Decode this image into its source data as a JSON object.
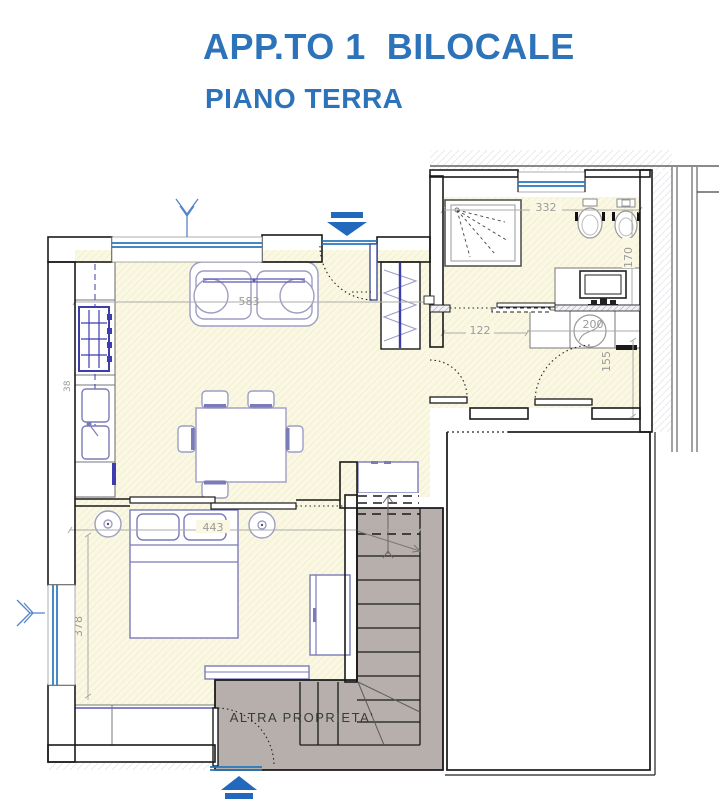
{
  "header": {
    "title": "APP.TO 1  BILOCALE",
    "subtitle": "PIANO TERRA"
  },
  "plan": {
    "dimensions": {
      "living_width": "583",
      "bath_width": "332",
      "bath_depth": "170",
      "hall_left": "122",
      "hall_right": "200",
      "hall_depth": "155",
      "bed_width": "443",
      "bed_depth": "378",
      "sink_width": "38"
    },
    "labels": {
      "other_property": "ALTRA PROPRIETA'"
    },
    "colors": {
      "accent_blue": "#2d73b9",
      "floor_yellow": "#faf8e2",
      "stair_gray": "#b6afab",
      "window_blue": "#2777bd",
      "furniture_blue": "#7b7bb8",
      "stove_blue": "#3d3dae",
      "dimension_gray": "#9a9a9a"
    }
  }
}
